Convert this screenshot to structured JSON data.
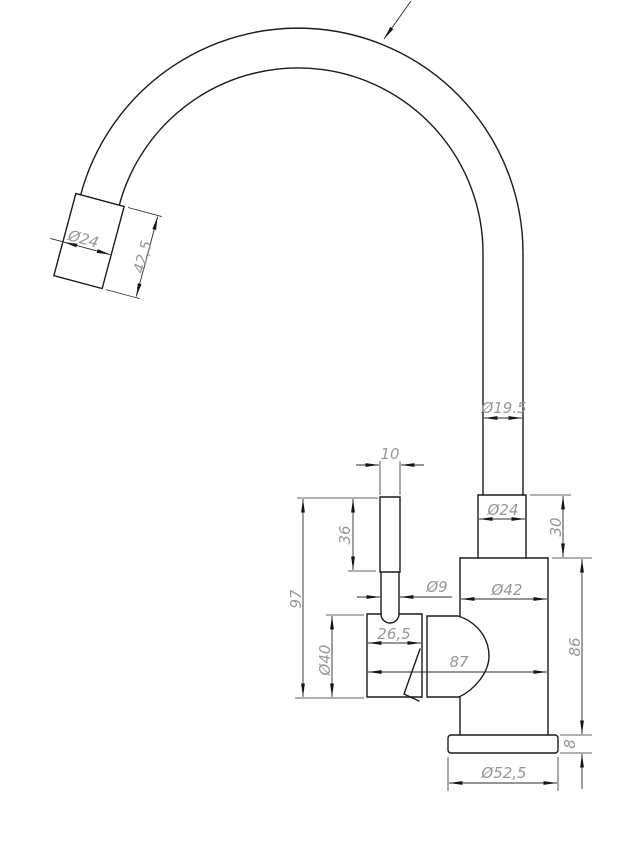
{
  "drawing": {
    "name": "Kitchen faucet dimensional drawing",
    "background": "#ffffff",
    "line_color": "#1b1b1b",
    "dim_line_color": "#2b2b2b",
    "dim_text_color": "#97979b"
  },
  "dimensions": {
    "spout_tip_diameter": {
      "label": "Ø24",
      "value_mm": 24
    },
    "spout_tip_length": {
      "label": "42,5",
      "value_mm": 42.5
    },
    "spout_tube_diameter": {
      "label": "Ø19.5",
      "value_mm": 19.5
    },
    "lever_top_width": {
      "label": "10",
      "value_mm": 10
    },
    "lever_height": {
      "label": "36",
      "value_mm": 36
    },
    "lever_stem_diameter": {
      "label": "Ø9",
      "value_mm": 9
    },
    "neck_diameter": {
      "label": "Ø24",
      "value_mm": 24
    },
    "neck_height": {
      "label": "30",
      "value_mm": 30
    },
    "body_diameter": {
      "label": "Ø42",
      "value_mm": 42
    },
    "handle_housing_diameter together": {
      "label": "Ø40",
      "value_mm": 40
    },
    "handle_housing_diameter": {
      "label": "Ø40",
      "value_mm": 40
    },
    "handle_housing_width": {
      "label": "26,5",
      "value_mm": 26.5
    },
    "overall_depth": {
      "label": "87",
      "value_mm": 87
    },
    "handle_top_height": {
      "label": "97",
      "value_mm": 97
    },
    "body_height": {
      "label": "86",
      "value_mm": 86
    },
    "base_plate_height": {
      "label": "8",
      "value_mm": 8
    },
    "base_plate_diameter": {
      "label": "Ø52,5",
      "value_mm": 52.5
    }
  }
}
